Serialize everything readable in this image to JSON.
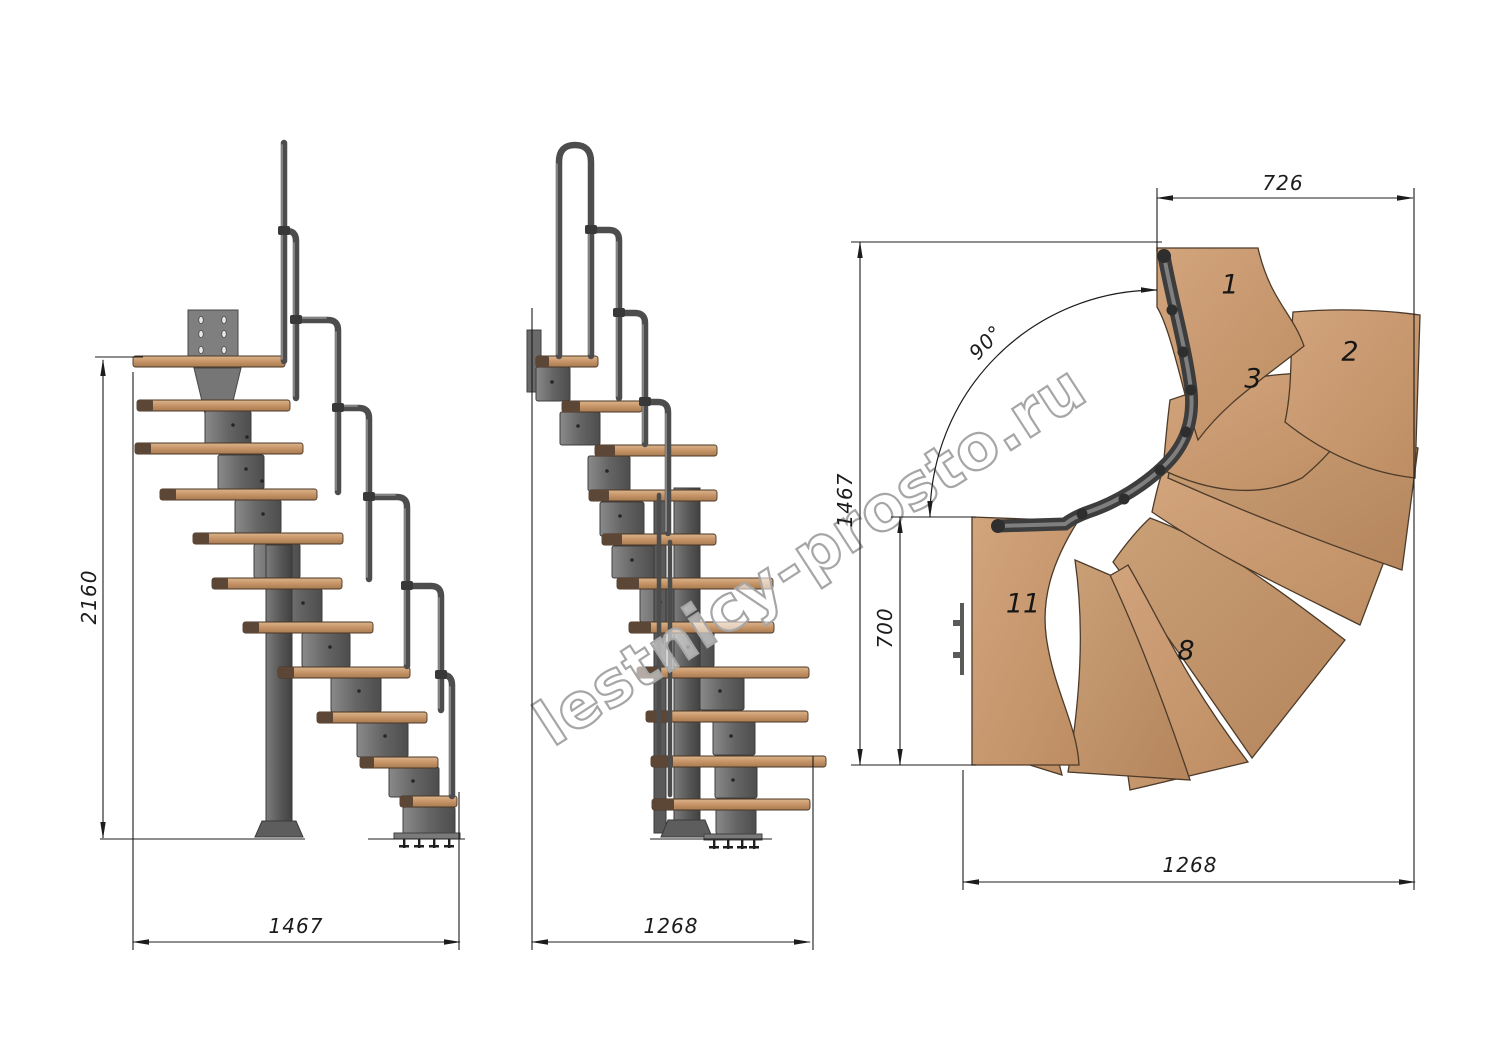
{
  "watermark": {
    "text": "lestnicy-prosto.ru"
  },
  "views": {
    "side_elevation_a": {
      "height_mm": "2160",
      "width_mm": "1467"
    },
    "side_elevation_b": {
      "width_mm": "1268"
    },
    "plan": {
      "top_width_mm": "726",
      "depth_mm": "1467",
      "landing_depth_mm": "700",
      "bottom_width_mm": "1268",
      "turn_angle": "90°",
      "tread_labels": {
        "t1": "1",
        "t2": "2",
        "t3": "3",
        "t8": "8",
        "t11": "11"
      }
    }
  },
  "colors": {
    "wood": "#c69467",
    "wood_dark": "#5c4636",
    "metal": "#6e6e6e",
    "metal_dark": "#3e3e3e",
    "rail": "#4f4f4f",
    "dimension_line": "#222222",
    "watermark_outline": "#a6a6a6"
  }
}
